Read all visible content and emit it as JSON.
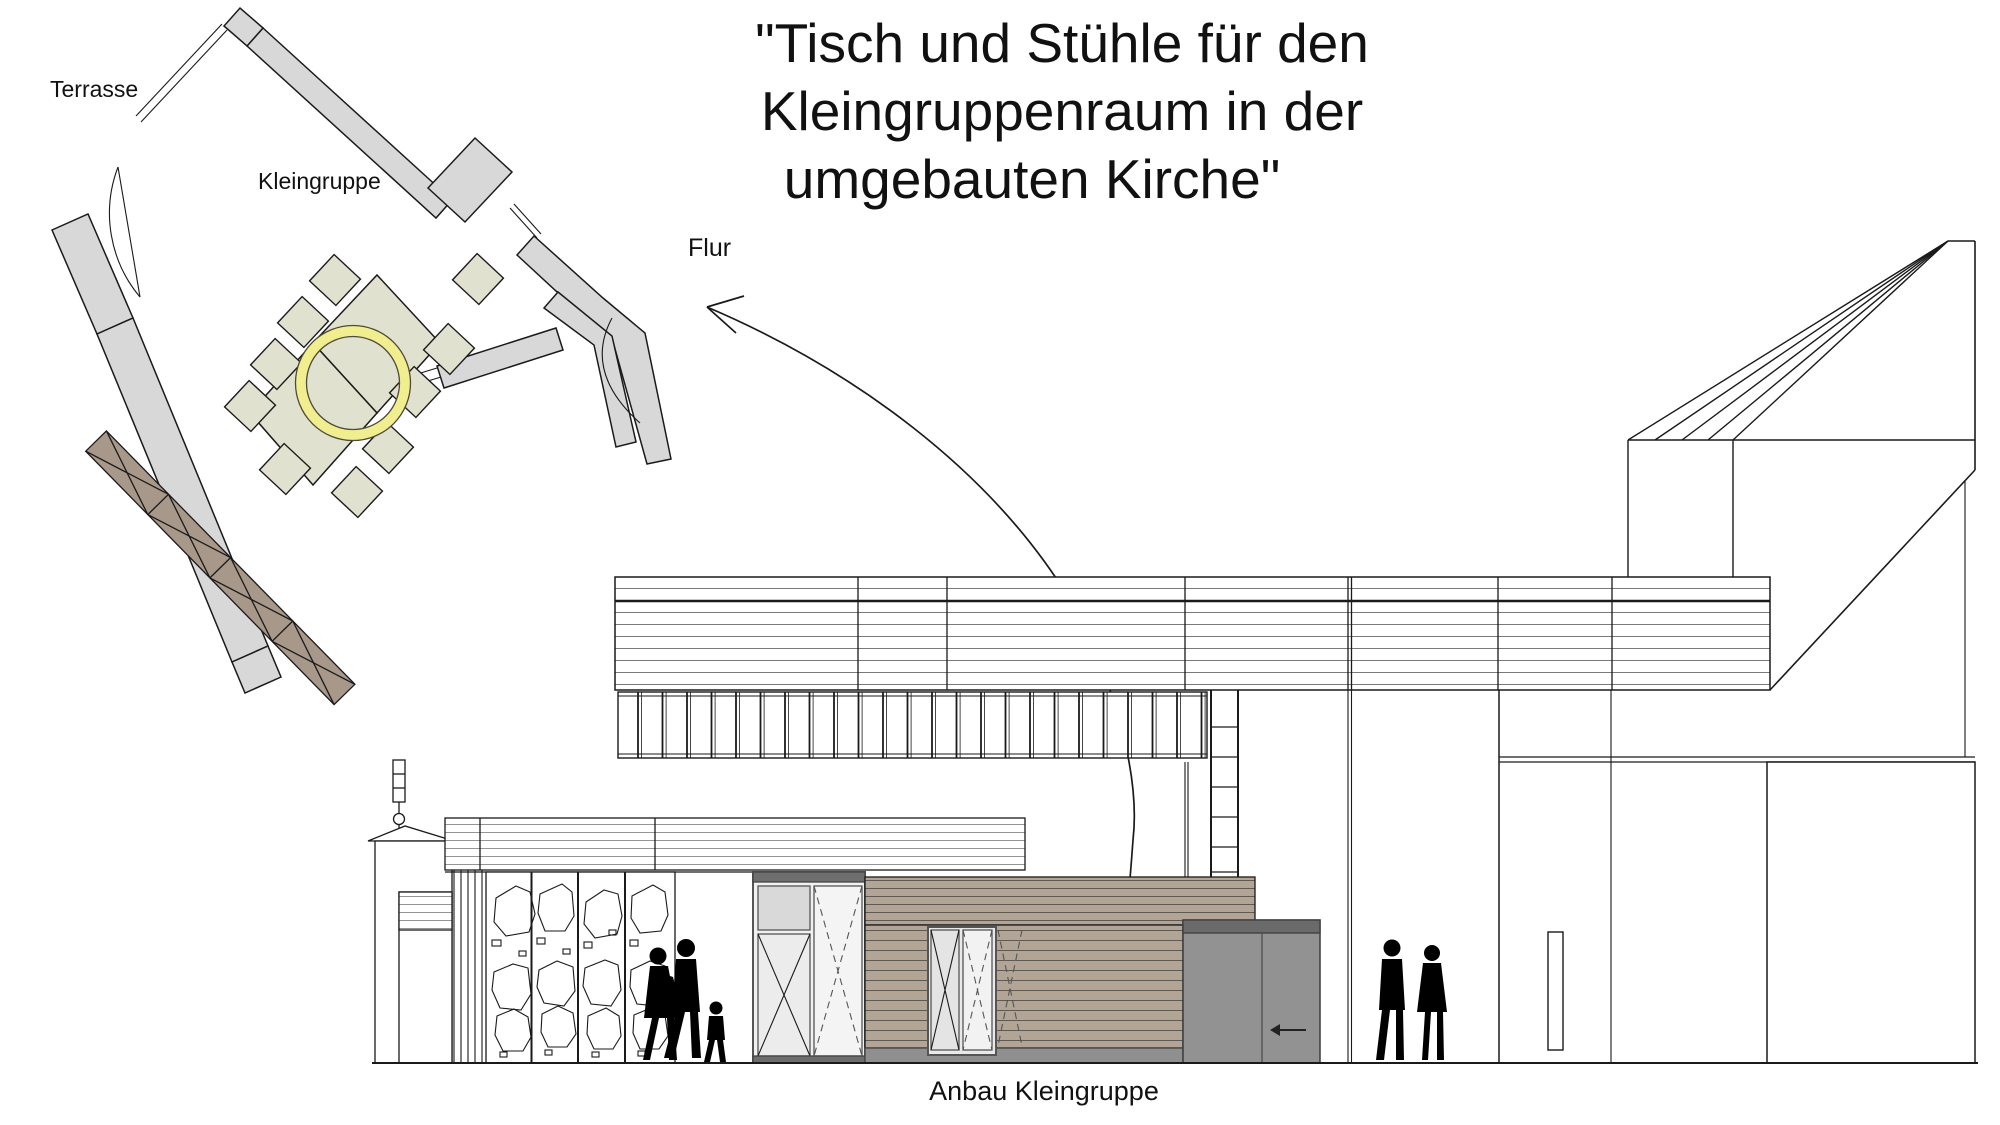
{
  "title": {
    "line1": "\"Tisch und Stühle für den",
    "line2": "Kleingruppenraum in der",
    "line3": "umgebauten Kirche\""
  },
  "floor_plan": {
    "labels": {
      "terrace": "Terrasse",
      "room": "Kleingruppe",
      "hallway": "Flur"
    },
    "furniture": {
      "tables": 2,
      "chairs": 10
    },
    "highlight": {
      "shape": "circle",
      "color": "#f1ee8f"
    }
  },
  "elevation": {
    "label": "Anbau Kleingruppe"
  },
  "colors": {
    "wall_gray": "#d8d8d8",
    "furniture_beige": "#e1e1cf",
    "sideboard_brown": "#a79889",
    "siding_tan": "#b3a596",
    "plinth_gray": "#8f8f8f",
    "sliding_door_gray": "#929292",
    "sliding_door_cap": "#6a6a6a",
    "door_frame_gray": "#6e6e6e",
    "highlight_yellow": "#f1ee8f",
    "line": "#1a1a1a"
  }
}
